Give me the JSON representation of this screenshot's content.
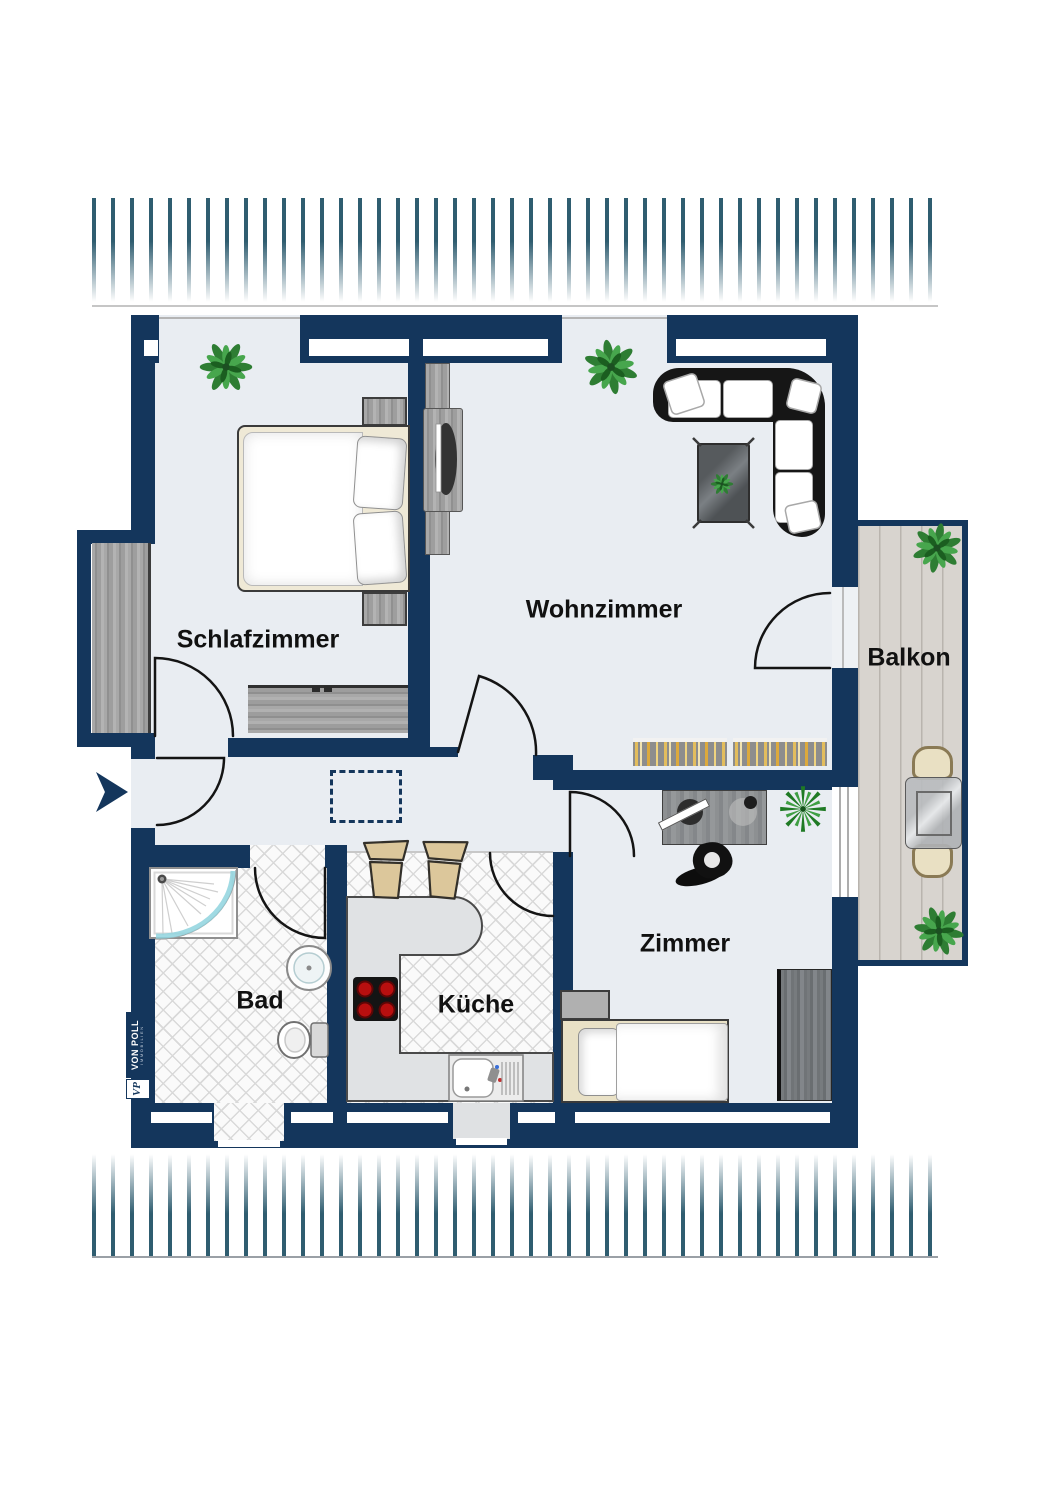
{
  "page": {
    "type": "apartment-floor-plan",
    "style": "top-down 2D color plan with roof hatching above and below"
  },
  "rooms": {
    "schlafzimmer": {
      "label": "Schlafzimmer"
    },
    "wohnzimmer": {
      "label": "Wohnzimmer"
    },
    "balkon": {
      "label": "Balkon"
    },
    "bad": {
      "label": "Bad"
    },
    "kueche": {
      "label": "Küche"
    },
    "zimmer": {
      "label": "Zimmer"
    }
  },
  "branding": {
    "name": "VON POLL",
    "subtitle": "IMMOBILIEN",
    "monogram": "VP"
  },
  "colors": {
    "wall": "#14365c",
    "room_floor": "#e9edf2",
    "tile_floor": "#fafafa",
    "tile_line": "#d9d9d9",
    "balcony_floor": "#d8d4cf",
    "balcony_line": "#b9b4ae",
    "hatch": "#2f5d70",
    "plant_green": "#2e7d33",
    "sofa_black": "#161616",
    "burner_red": "#b80f0f"
  }
}
